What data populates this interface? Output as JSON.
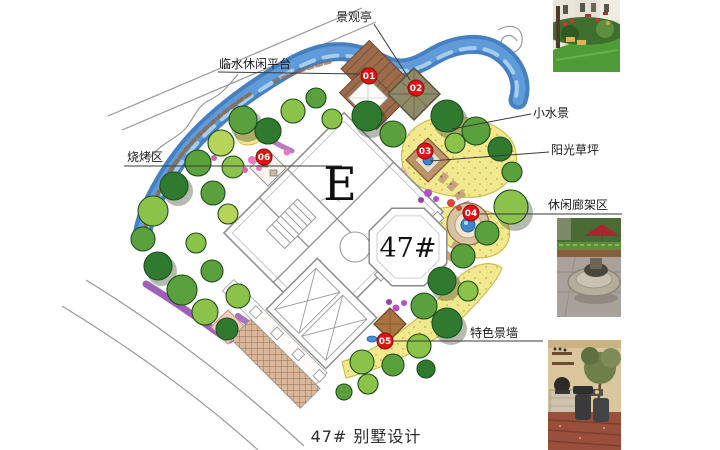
{
  "page": {
    "caption": "47# 别墅设计"
  },
  "plan": {
    "building_block_label": "E",
    "building_unit_label": "47#",
    "callouts": {
      "pavilion": "景观亭",
      "waterside_platform": "临水休闲平台",
      "bbq_area": "烧烤区",
      "water_feature": "小水景",
      "sunny_lawn": "阳光草坪",
      "pergola_area": "休闲廊架区",
      "feature_wall": "特色景墙"
    },
    "markers": [
      "01",
      "02",
      "03",
      "04",
      "05",
      "06"
    ],
    "colors": {
      "marker_red": "#e11212",
      "river_blue": "#3c79c0",
      "lawn_yellow": "#f2e98f",
      "tree_green": "#4f9e3d",
      "deck_brown": "#9c6b4a"
    }
  }
}
